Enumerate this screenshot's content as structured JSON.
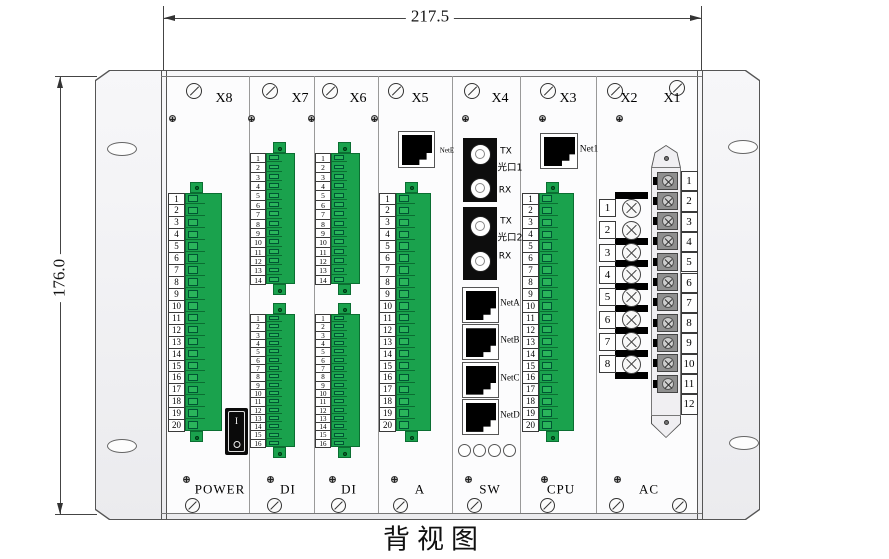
{
  "caption": "背视图",
  "dim": {
    "width": "217.5",
    "height": "176.0"
  },
  "pin_sets": {
    "s20": [
      "1",
      "2",
      "3",
      "4",
      "5",
      "6",
      "7",
      "8",
      "9",
      "10",
      "11",
      "12",
      "13",
      "14",
      "15",
      "16",
      "17",
      "18",
      "19",
      "20"
    ],
    "s14": [
      "1",
      "2",
      "3",
      "4",
      "5",
      "6",
      "7",
      "8",
      "9",
      "10",
      "11",
      "12",
      "13",
      "14"
    ],
    "s16": [
      "1",
      "2",
      "3",
      "4",
      "5",
      "6",
      "7",
      "8",
      "9",
      "10",
      "11",
      "12",
      "13",
      "14",
      "15",
      "16"
    ],
    "s8": [
      "1",
      "2",
      "3",
      "4",
      "5",
      "6",
      "7",
      "8"
    ],
    "s12": [
      "1",
      "2",
      "3",
      "4",
      "5",
      "6",
      "7",
      "8",
      "9",
      "10",
      "11",
      "12"
    ]
  },
  "slots": {
    "x8": {
      "top_label": "X8",
      "module_label": "POWER",
      "pins": "s20",
      "switch": {
        "on": "I",
        "off": "O"
      }
    },
    "x7": {
      "top_label": "X7",
      "module_label": "DI",
      "blocks": [
        "s14",
        "s16"
      ]
    },
    "x6": {
      "top_label": "X6",
      "module_label": "DI",
      "blocks": [
        "s14",
        "s16"
      ]
    },
    "x5": {
      "top_label": "X5",
      "module_label": "A",
      "ethernet": "NetE",
      "pins": "s20"
    },
    "x4": {
      "top_label": "X4",
      "module_label": "SW",
      "optical": [
        {
          "tx": "TX",
          "label": "光口1",
          "rx": "RX"
        },
        {
          "tx": "TX",
          "label": "光口2",
          "rx": "RX"
        }
      ],
      "ethernet": [
        "NetA",
        "NetB",
        "NetC",
        "NetD"
      ],
      "led_count": 4
    },
    "x3": {
      "top_label": "X3",
      "module_label": "CPU",
      "ethernet": "Net1",
      "pins": "s20"
    },
    "ac": {
      "top_labels": [
        "X2",
        "X1"
      ],
      "module_label": "AC",
      "screw_terminal_pins": "s8",
      "strip_pins": "s12",
      "strip_empty_position": "12"
    }
  },
  "colors": {
    "terminal_green": "#1aa24d",
    "terminal_green_dark": "#0b6e32",
    "panel_line": "#777777"
  }
}
